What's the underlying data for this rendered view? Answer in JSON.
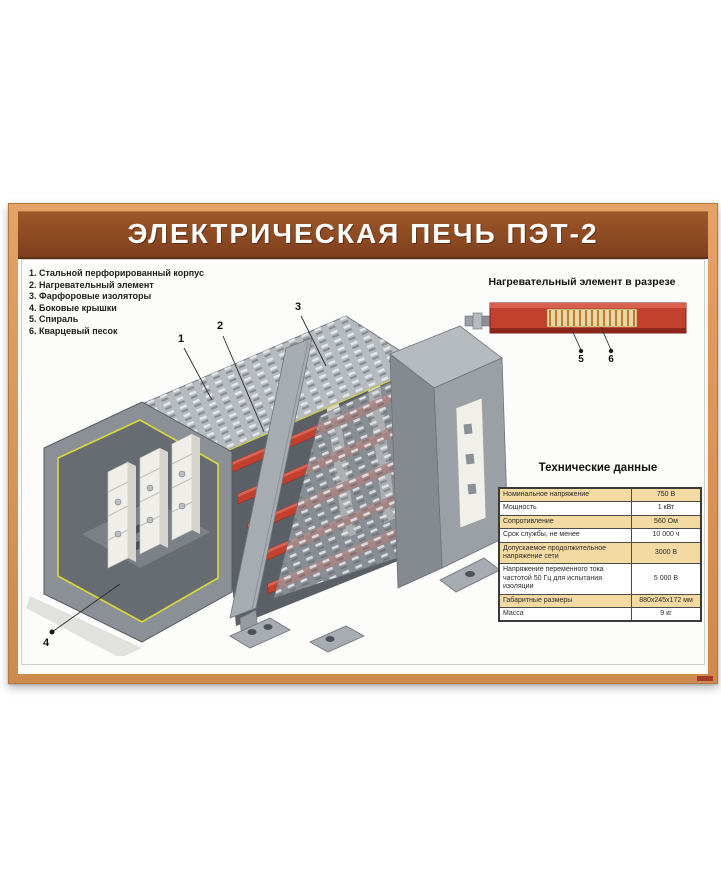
{
  "title": "ЭЛЕКТРИЧЕСКАЯ ПЕЧЬ ПЭТ-2",
  "legend": {
    "lines": [
      "1. Стальной перфорированный корпус",
      "2. Нагревательный элемент",
      "3. Фарфоровые изоляторы",
      "4. Боковые крышки",
      "5. Спираль",
      "6. Кварцевый песок"
    ]
  },
  "diagram": {
    "callouts": [
      "1",
      "2",
      "3",
      "4"
    ]
  },
  "cross_section": {
    "heading": "Нагревательный элемент в разрезе",
    "callouts": [
      "5",
      "6"
    ]
  },
  "spec_table": {
    "title": "Технические данные",
    "rows": [
      {
        "label": "Номинальное напряжение",
        "value": "750 В"
      },
      {
        "label": "Мощность",
        "value": "1 кВт"
      },
      {
        "label": "Сопротивление",
        "value": "560 Ом"
      },
      {
        "label": "Срок службы, не менее",
        "value": "10 000 ч"
      },
      {
        "label": "Допускаемое продолжительное напряжение сети",
        "value": "3000 В"
      },
      {
        "label": "Напряжение переменного тока частотой 50 Гц для испытания изоляции",
        "value": "5 000 В"
      },
      {
        "label": "Габаритные размеры",
        "value": "880х245х172 мм"
      },
      {
        "label": "Масса",
        "value": "9 кг"
      }
    ]
  },
  "colors": {
    "frame_orange": "#d9955a",
    "banner_brown": "#8d4b24",
    "table_row_tan": "#f3d9a2",
    "tube_red": "#c2402e",
    "trim_yellow": "#ddd83a",
    "housing_gray": "#9aa0a6"
  }
}
